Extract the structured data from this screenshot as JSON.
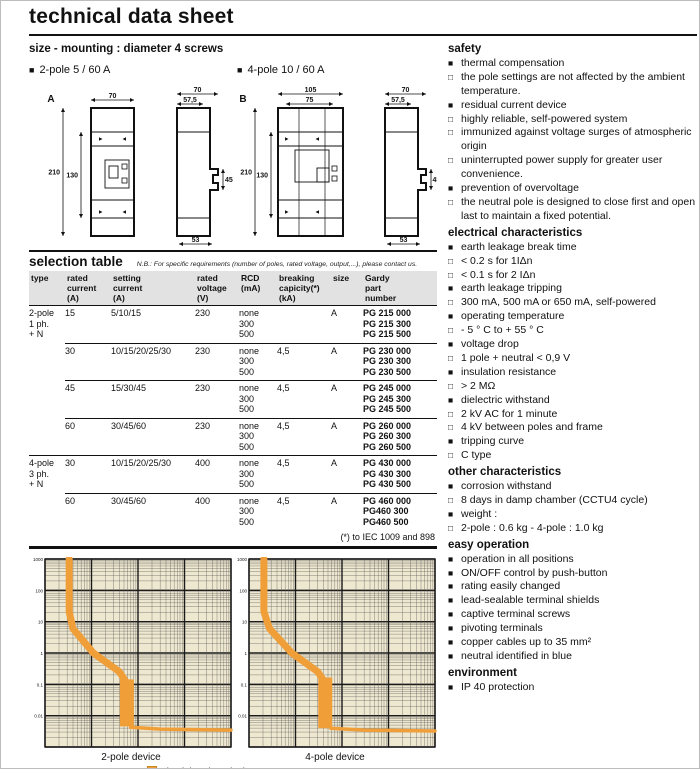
{
  "header": {
    "title": "technical data sheet"
  },
  "size_section": {
    "heading": "size - mounting : diameter 4 screws",
    "variants": [
      {
        "marker": "■",
        "label": "2-pole 5 / 60 A"
      },
      {
        "marker": "■",
        "label": "4-pole 10 / 60 A"
      }
    ]
  },
  "diagrams": [
    {
      "id": "A",
      "front": {
        "top_width": "70",
        "height": "210",
        "inner_height": "130"
      },
      "side": {
        "top_width": "70",
        "inner_width": "57,5",
        "notch_height": "45",
        "bottom_width": "53"
      }
    },
    {
      "id": "B",
      "front": {
        "top_width": "105",
        "inner_width": "75",
        "height": "210",
        "inner_height": "130"
      },
      "side": {
        "top_width": "70",
        "inner_width": "57,5",
        "notch_height": "45",
        "bottom_width": "53"
      }
    }
  ],
  "selection_table": {
    "title": "selection table",
    "note": "N.B.: For specific requirements (number of poles, rated voltage, output,...), please contact us.",
    "columns": [
      [
        "type"
      ],
      [
        "rated",
        "current",
        "(A)"
      ],
      [
        "setting",
        "current",
        "(A)"
      ],
      [
        "rated",
        "voltage",
        "(V)"
      ],
      [
        "RCD",
        "(mA)"
      ],
      [
        "breaking",
        "capicity(*)",
        "(kA)"
      ],
      [
        "size"
      ],
      [
        "Gardy",
        "part",
        "number"
      ]
    ],
    "footnote": "(*) to IEC 1009 and 898",
    "groups": [
      {
        "type_lines": [
          "2-pole",
          "1 ph.",
          "+ N"
        ],
        "rows": [
          {
            "rated": "15",
            "setting": "5/10/15",
            "voltage": "230",
            "rcd": [
              "none",
              "300",
              "500"
            ],
            "breaking": "",
            "size": "A",
            "parts": [
              "PG 215 000",
              "PG 215 300",
              "PG 215 500"
            ]
          },
          {
            "rated": "30",
            "setting": "10/15/20/25/30",
            "voltage": "230",
            "rcd": [
              "none",
              "300",
              "500"
            ],
            "breaking": "4,5",
            "size": "A",
            "parts": [
              "PG 230 000",
              "PG 230 300",
              "PG 230 500"
            ]
          },
          {
            "rated": "45",
            "setting": "15/30/45",
            "voltage": "230",
            "rcd": [
              "none",
              "300",
              "500"
            ],
            "breaking": "4,5",
            "size": "A",
            "parts": [
              "PG 245 000",
              "PG 245 300",
              "PG 245 500"
            ]
          },
          {
            "rated": "60",
            "setting": "30/45/60",
            "voltage": "230",
            "rcd": [
              "none",
              "300",
              "500"
            ],
            "breaking": "4,5",
            "size": "A",
            "parts": [
              "PG 260 000",
              "PG 260 300",
              "PG 260 500"
            ]
          }
        ]
      },
      {
        "type_lines": [
          "4-pole",
          "3 ph.",
          "+ N"
        ],
        "rows": [
          {
            "rated": "30",
            "setting": "10/15/20/25/30",
            "voltage": "400",
            "rcd": [
              "none",
              "300",
              "500"
            ],
            "breaking": "4,5",
            "size": "A",
            "parts": [
              "PG 430 000",
              "PG 430 300",
              "PG 430 500"
            ]
          },
          {
            "rated": "60",
            "setting": "30/45/60",
            "voltage": "400",
            "rcd": [
              "none",
              "300",
              "500"
            ],
            "breaking": "4,5",
            "size": "A",
            "parts": [
              "PG 460 000",
              "PG460 300",
              "PG460 500"
            ]
          }
        ]
      }
    ]
  },
  "chart_data": [
    {
      "type": "area",
      "caption": "2-pole device",
      "x_scale": "log",
      "y_scale": "log",
      "x_decades": 4,
      "y_decades": 6,
      "y_tick_labels": [
        "1000",
        "100",
        "10",
        "1",
        "0.1",
        "0.01"
      ],
      "curve_norm": {
        "spine": [
          [
            0.13,
            0.0
          ],
          [
            0.13,
            0.28
          ],
          [
            0.15,
            0.37
          ],
          [
            0.26,
            0.5
          ],
          [
            0.4,
            0.6
          ],
          [
            0.43,
            0.645
          ]
        ],
        "band": [
          0.44,
          0.64,
          0.89
        ],
        "tail": [
          [
            0.46,
            0.895
          ],
          [
            0.62,
            0.905
          ],
          [
            1.0,
            0.91
          ]
        ]
      }
    },
    {
      "type": "area",
      "caption": "4-pole device",
      "x_scale": "log",
      "y_scale": "log",
      "x_decades": 4,
      "y_decades": 6,
      "y_tick_labels": [
        "1000",
        "100",
        "10",
        "1",
        "0.1",
        "0.01"
      ],
      "curve_norm": {
        "spine": [
          [
            0.08,
            0.0
          ],
          [
            0.08,
            0.28
          ],
          [
            0.11,
            0.37
          ],
          [
            0.23,
            0.5
          ],
          [
            0.37,
            0.6
          ],
          [
            0.4,
            0.645
          ]
        ],
        "band": [
          0.41,
          0.63,
          0.9
        ],
        "tail": [
          [
            0.44,
            0.9
          ],
          [
            0.62,
            0.91
          ],
          [
            1.0,
            0.915
          ]
        ]
      }
    }
  ],
  "legend": {
    "marker": "■",
    "label": "circuit breaker tripping zones"
  },
  "sidebar": {
    "sections": [
      {
        "title": "safety",
        "items": [
          {
            "marker": "filled",
            "text": "thermal compensation"
          },
          {
            "marker": "hollow",
            "text": "the pole settings are not affected by the ambient temperature."
          },
          {
            "marker": "filled",
            "text": "residual current device"
          },
          {
            "marker": "hollow",
            "text": "highly reliable, self-powered system"
          },
          {
            "marker": "hollow",
            "text": "immunized against voltage surges of atmospheric origin"
          },
          {
            "marker": "hollow",
            "text": "uninterrupted power supply for greater user convenience."
          },
          {
            "marker": "filled",
            "text": "prevention of overvoltage"
          },
          {
            "marker": "hollow",
            "text": "the neutral pole is designed to close first and open last to maintain a fixed potential."
          }
        ]
      },
      {
        "title": "electrical characteristics",
        "items": [
          {
            "marker": "filled",
            "text": "earth leakage break time"
          },
          {
            "marker": "hollow",
            "text": "< 0.2 s for 1IΔn"
          },
          {
            "marker": "hollow",
            "text": "< 0.1 s for 2 IΔn"
          },
          {
            "marker": "filled",
            "text": "earth leakage tripping"
          },
          {
            "marker": "hollow",
            "text": "300 mA, 500 mA  or 650 mA, self-powered"
          },
          {
            "marker": "filled",
            "text": "operating temperature"
          },
          {
            "marker": "hollow",
            "text": "- 5 ° C to + 55 ° C"
          },
          {
            "marker": "filled",
            "text": "voltage drop"
          },
          {
            "marker": "hollow",
            "text": "1 pole + neutral < 0,9 V"
          },
          {
            "marker": "filled",
            "text": "insulation resistance"
          },
          {
            "marker": "hollow",
            "text": "> 2 MΩ"
          },
          {
            "marker": "filled",
            "text": "dielectric withstand"
          },
          {
            "marker": "hollow",
            "text": "2 kV AC for 1 minute"
          },
          {
            "marker": "hollow",
            "text": "4 kV between poles and frame"
          },
          {
            "marker": "filled",
            "text": "tripping curve"
          },
          {
            "marker": "hollow",
            "text": "C type"
          }
        ]
      },
      {
        "title": "other characteristics",
        "items": [
          {
            "marker": "filled",
            "text": "corrosion withstand"
          },
          {
            "marker": "hollow",
            "text": "8 days in damp chamber (CCTU4 cycle)"
          },
          {
            "marker": "filled",
            "text": "weight :"
          },
          {
            "marker": "hollow",
            "text": "2-pole : 0.6 kg - 4-pole : 1.0 kg"
          }
        ]
      },
      {
        "title": "easy operation",
        "items": [
          {
            "marker": "filled",
            "text": "operation in all positions"
          },
          {
            "marker": "filled",
            "text": "ON/OFF control by push-button"
          },
          {
            "marker": "filled",
            "text": "rating easily changed"
          },
          {
            "marker": "filled",
            "text": "lead-sealable terminal shields"
          },
          {
            "marker": "filled",
            "text": "captive terminal screws"
          },
          {
            "marker": "filled",
            "text": "pivoting terminals"
          },
          {
            "marker": "filled",
            "text": "copper cables up to 35 mm²"
          },
          {
            "marker": "filled",
            "text": "neutral identified in blue"
          }
        ]
      },
      {
        "title": "environment",
        "items": [
          {
            "marker": "filled",
            "text": "IP 40 protection"
          }
        ]
      }
    ]
  },
  "colors": {
    "curve_orange": "#f09e38",
    "chart_bg": "#efe8d0",
    "table_header_bg": "#e2e2e2",
    "ink": "#111111"
  }
}
